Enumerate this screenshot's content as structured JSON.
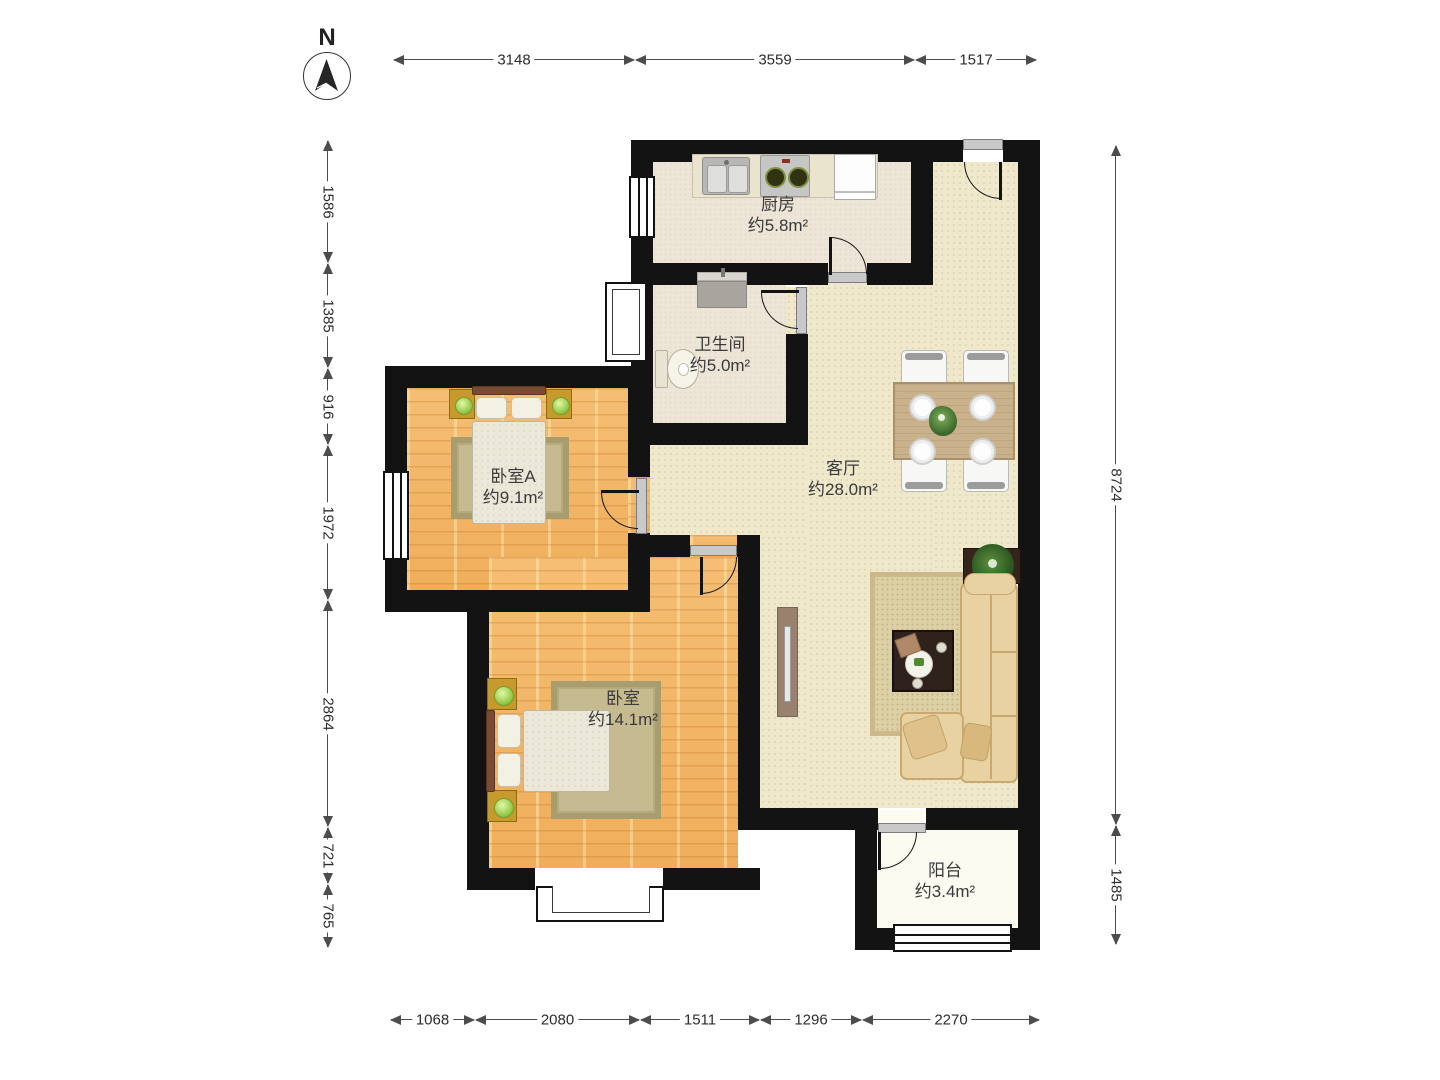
{
  "compass": {
    "label": "N"
  },
  "dimensions": {
    "top": [
      "3148",
      "3559",
      "1517"
    ],
    "left": [
      "1586",
      "1385",
      "916",
      "1972",
      "2864",
      "721",
      "765"
    ],
    "right": [
      "8724",
      "1485"
    ],
    "bottom": [
      "1068",
      "2080",
      "1511",
      "1296",
      "2270"
    ]
  },
  "rooms": {
    "kitchen": {
      "name": "厨房",
      "area": "约5.8m²"
    },
    "bathroom": {
      "name": "卫生间",
      "area": "约5.0m²"
    },
    "bedroom_a": {
      "name": "卧室A",
      "area": "约9.1m²"
    },
    "bedroom": {
      "name": "卧室",
      "area": "约14.1m²"
    },
    "living": {
      "name": "客厅",
      "area": "约28.0m²"
    },
    "balcony": {
      "name": "阳台",
      "area": "约3.4m²"
    }
  },
  "colors": {
    "wall": "#131313",
    "wood_floor": "#F2B567",
    "living_floor": "#EFE8CB",
    "kitchen_floor": "#EDE5D7",
    "balcony_floor": "#FCFBF1",
    "dimension_line": "#4c4c4c"
  }
}
